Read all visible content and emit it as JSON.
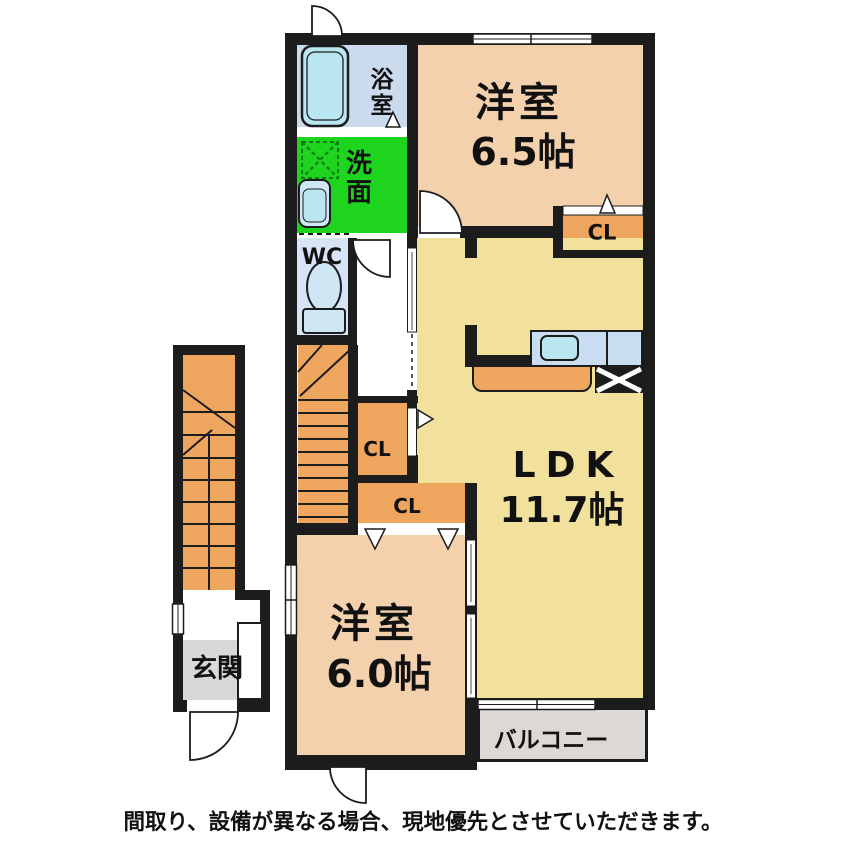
{
  "floorplan": {
    "type": "apartment-floor-plan",
    "rooms": [
      {
        "id": "western-room-65",
        "name": "洋室",
        "size": "6.5帖"
      },
      {
        "id": "ldk",
        "name": "LDK",
        "size": "11.7帖"
      },
      {
        "id": "western-room-60",
        "name": "洋室",
        "size": "6.0帖"
      },
      {
        "id": "bathroom",
        "name": "浴室"
      },
      {
        "id": "washroom",
        "name": "洗面"
      },
      {
        "id": "toilet",
        "name": "WC"
      },
      {
        "id": "entrance",
        "name": "玄関"
      },
      {
        "id": "balcony",
        "name": "バルコニー"
      }
    ],
    "closets": [
      {
        "id": "closet-room65",
        "label": "CL"
      },
      {
        "id": "closet-hall",
        "label": "CL"
      },
      {
        "id": "closet-room60",
        "label": "CL"
      }
    ],
    "disclaimer": "間取り、設備が異なる場合、現地優先とさせていただきます。"
  },
  "colors": {
    "wall": "#1c1c1c",
    "room-peach": "#f4d1ad",
    "room-yellow": "#f2e19d",
    "closet-orange": "#eea55e",
    "washroom-green": "#1fd41f",
    "bath-bg": "#ccdaee",
    "wc-bg": "#d6e4f5",
    "fixture-blue": "#cfe7f5",
    "water-blue": "#b9e6f1",
    "counter-blue": "#c9ddf1",
    "balcony-bg": "#ded8d4",
    "entrance-gray": "#d8d8d8"
  }
}
